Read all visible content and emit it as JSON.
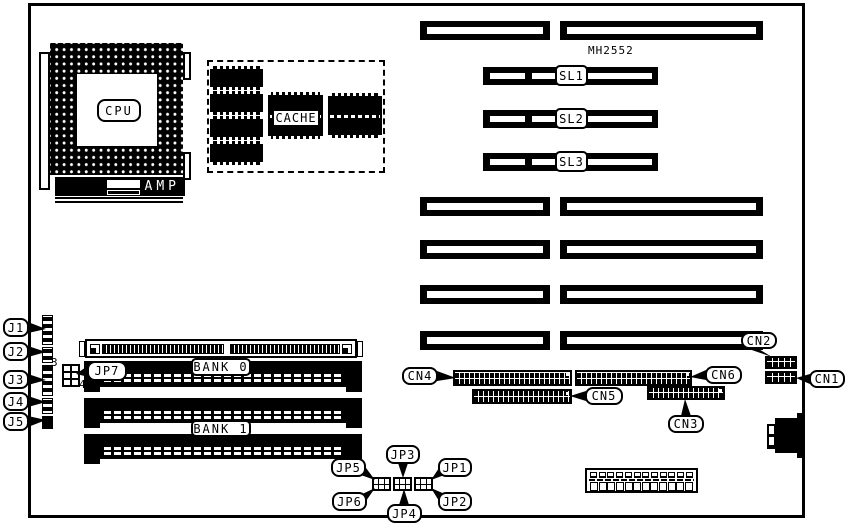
{
  "labels": {
    "cpu": "CPU",
    "amp": "AMP",
    "cache": "CACHE",
    "mh2552": "MH2552",
    "sl1": "SL1",
    "sl2": "SL2",
    "sl3": "SL3",
    "bank0": "BANK 0",
    "bank1": "BANK 1",
    "j1": "J1",
    "j2": "J2",
    "j3": "J3",
    "j4": "J4",
    "j5": "J5",
    "jp1": "JP1",
    "jp2": "JP2",
    "jp3": "JP3",
    "jp4": "JP4",
    "jp5": "JP5",
    "jp6": "JP6",
    "jp7": "JP7",
    "jp7_pin_top": "3",
    "jp7_pin_bottom": "4",
    "cn1": "CN1",
    "cn2": "CN2",
    "cn3": "CN3",
    "cn4": "CN4",
    "cn5": "CN5",
    "cn6": "CN6"
  },
  "colors": {
    "ink": "#000000",
    "paper": "#ffffff"
  }
}
